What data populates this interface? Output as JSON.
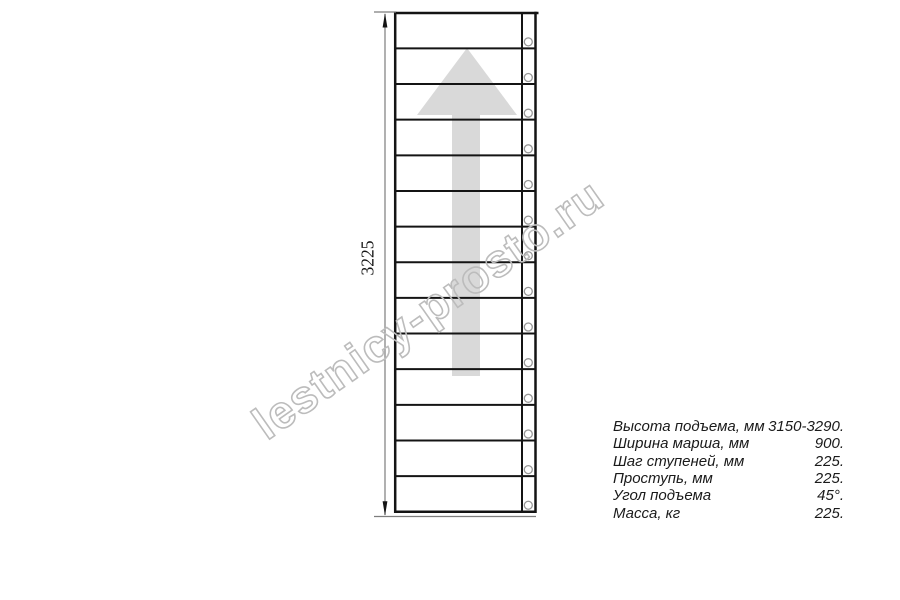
{
  "drawing": {
    "dimension_label": "3225",
    "steps_count": 14,
    "watermark": "lestnicy-prosto.ru",
    "colors": {
      "line": "#141414",
      "dim": "#7d7d7d",
      "watermark": "#bcbcbc",
      "arrow": "#d9d9d9",
      "screw": "#979797"
    }
  },
  "specs": {
    "rows": [
      {
        "label": "Высота подъема, мм",
        "value": "3150-3290."
      },
      {
        "label": "Ширина марша, мм",
        "value": "900."
      },
      {
        "label": "Шаг ступеней, мм",
        "value": "225."
      },
      {
        "label": "Проступь, мм",
        "value": "225."
      },
      {
        "label": "Угол подъема",
        "value": "45°."
      },
      {
        "label": "Масса, кг",
        "value": "225."
      }
    ]
  }
}
